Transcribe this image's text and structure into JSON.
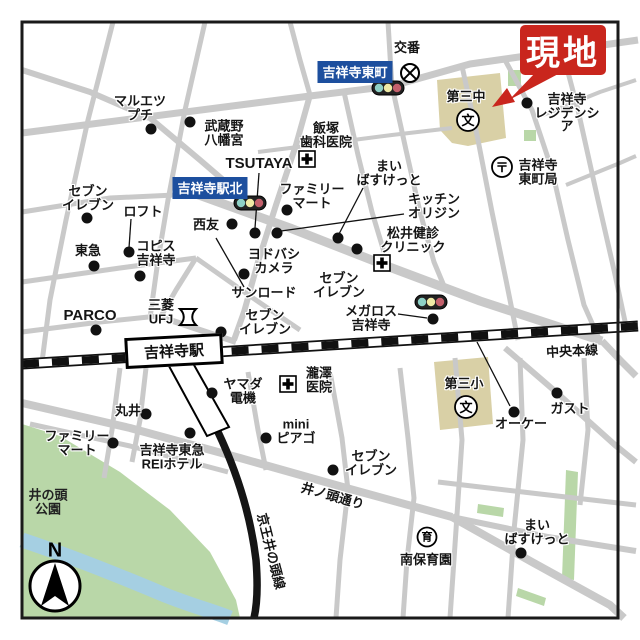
{
  "map": {
    "background": "#ffffff",
    "border_color": "#1a1a1a",
    "road_color": "#c9c9c9",
    "park_color": "#b9d7a8",
    "water_color": "#a5cfe2",
    "school_building_color": "#d9d0a6",
    "site_callout": {
      "label": "現地",
      "color": "#c9261d",
      "text_color": "#ffffff"
    },
    "sign_color": "#1d4f9e",
    "signs": [
      {
        "label": "吉祥寺東町",
        "x": 355,
        "y": 72
      },
      {
        "label": "吉祥寺駅北",
        "x": 210,
        "y": 188
      }
    ],
    "station_label": {
      "label": "吉祥寺駅"
    },
    "line_labels": [
      {
        "label": "中央本線",
        "x": 572,
        "y": 350,
        "rot": -3
      },
      {
        "label": "京王井の頭線",
        "x": 272,
        "y": 551,
        "rot": 76
      },
      {
        "label": "井ノ頭通り",
        "x": 333,
        "y": 495,
        "rot": 16
      }
    ],
    "area_labels": [
      {
        "label": "井の頭\n公園",
        "x": 48,
        "y": 503
      }
    ],
    "compass": {
      "label": "N"
    },
    "traffic_light_colors": [
      "#8ed1c6",
      "#efeaa6",
      "#c4606c"
    ],
    "traffic_lights": [
      [
        388,
        88
      ],
      [
        250,
        203
      ],
      [
        431,
        302
      ]
    ],
    "symbol_defs": {
      "school": {
        "glyph": "文"
      },
      "nursery": {
        "glyph": "育"
      },
      "post": {
        "glyph": "〒"
      },
      "koban": {
        "glyph": ""
      },
      "hospital": {
        "glyph": ""
      },
      "bank": {
        "glyph": ""
      }
    },
    "pois": [
      {
        "label": "マルエツ\nプチ",
        "lx": 140,
        "ly": 108,
        "dot": [
          151,
          129
        ]
      },
      {
        "label": "武蔵野\n八幡宮",
        "lx": 224,
        "ly": 133,
        "dot": [
          190,
          122
        ]
      },
      {
        "label": "飯塚\n歯科医院",
        "lx": 326,
        "ly": 135,
        "symbol": {
          "type": "hospital",
          "x": 307,
          "y": 159
        }
      },
      {
        "label": "TSUTAYA",
        "lx": 259,
        "ly": 164,
        "fs": 15,
        "dot": [
          255,
          233
        ],
        "leader": [
          259,
          173,
          255,
          228
        ]
      },
      {
        "label": "ファミリー\nマート",
        "lx": 312,
        "ly": 196,
        "dot": [
          287,
          210
        ]
      },
      {
        "label": "まい\nばすけっと",
        "lx": 389,
        "ly": 173,
        "dot": [
          338,
          238
        ],
        "leader": [
          363,
          188,
          339,
          234
        ]
      },
      {
        "label": "キッチン\nオリジン",
        "lx": 434,
        "ly": 206,
        "dot": [
          277,
          233
        ],
        "leader": [
          404,
          214,
          281,
          231
        ]
      },
      {
        "label": "松井健診\nクリニック",
        "lx": 413,
        "ly": 240,
        "symbol": {
          "type": "hospital",
          "x": 382,
          "y": 263
        }
      },
      {
        "label": "セブン\nイレブン",
        "lx": 88,
        "ly": 198,
        "dot": [
          87,
          218
        ]
      },
      {
        "label": "ロフト",
        "lx": 143,
        "ly": 212,
        "dot": [
          129,
          252
        ],
        "leader": [
          131,
          219,
          129,
          248
        ]
      },
      {
        "label": "西友",
        "lx": 206,
        "ly": 225,
        "dot": [
          232,
          224
        ]
      },
      {
        "label": "東急",
        "lx": 88,
        "ly": 251,
        "dot": [
          94,
          266
        ]
      },
      {
        "label": "コピス\n吉祥寺",
        "lx": 156,
        "ly": 253,
        "dot": [
          140,
          276
        ]
      },
      {
        "label": "ヨドバシ\nカメラ",
        "lx": 274,
        "ly": 261,
        "dot": [
          244,
          274
        ]
      },
      {
        "label": "サンロード",
        "lx": 264,
        "ly": 293,
        "leader": [
          244,
          287,
          216,
          238
        ]
      },
      {
        "label": "セブン\nイレブン",
        "lx": 339,
        "ly": 285,
        "dot": [
          357,
          249
        ]
      },
      {
        "label": "メガロス\n吉祥寺",
        "lx": 371,
        "ly": 318,
        "dot": [
          433,
          319
        ],
        "leader": [
          398,
          314,
          427,
          318
        ]
      },
      {
        "label": "三菱\nUFJ",
        "lx": 161,
        "ly": 312,
        "symbol": {
          "type": "bank",
          "x": 188,
          "y": 317
        }
      },
      {
        "label": "PARCO",
        "lx": 90,
        "ly": 316,
        "fs": 15,
        "dot": [
          96,
          330
        ]
      },
      {
        "label": "セブン\nイレブン",
        "lx": 265,
        "ly": 322,
        "dot": [
          221,
          332
        ]
      },
      {
        "label": "吉祥寺\nレジデンシア",
        "lx": 567,
        "ly": 113,
        "dot": [
          527,
          103
        ]
      },
      {
        "label": "第三中",
        "lx": 466,
        "ly": 97,
        "symbol": {
          "type": "school",
          "x": 468,
          "y": 120
        }
      },
      {
        "label": "吉祥寺\n東町局",
        "lx": 538,
        "ly": 172,
        "symbol": {
          "type": "post",
          "x": 502,
          "y": 167
        }
      },
      {
        "label": "交番",
        "lx": 407,
        "ly": 48,
        "symbol": {
          "type": "koban",
          "x": 410,
          "y": 73
        }
      },
      {
        "label": "ヤマダ\n電機",
        "lx": 243,
        "ly": 391,
        "dot": [
          212,
          393
        ]
      },
      {
        "label": "瀧澤\n医院",
        "lx": 319,
        "ly": 380,
        "symbol": {
          "type": "hospital",
          "x": 288,
          "y": 384
        }
      },
      {
        "label": "丸井",
        "lx": 128,
        "ly": 411,
        "dot": [
          146,
          414
        ]
      },
      {
        "label": "mini\nピアゴ",
        "lx": 296,
        "ly": 431,
        "dot": [
          266,
          438
        ]
      },
      {
        "label": "ファミリー\nマート",
        "lx": 77,
        "ly": 443,
        "dot": [
          113,
          443
        ]
      },
      {
        "label": "吉祥寺東急\nREIホテル",
        "lx": 172,
        "ly": 457,
        "dot": [
          190,
          433
        ]
      },
      {
        "label": "セブン\nイレブン",
        "lx": 371,
        "ly": 463,
        "dot": [
          333,
          470
        ]
      },
      {
        "label": "オーケー",
        "lx": 521,
        "ly": 424,
        "dot": [
          514,
          412
        ],
        "leader": [
          510,
          406,
          477,
          342
        ]
      },
      {
        "label": "ガスト",
        "lx": 570,
        "ly": 409,
        "dot": [
          557,
          393
        ]
      },
      {
        "label": "第三小",
        "lx": 464,
        "ly": 384,
        "symbol": {
          "type": "school",
          "x": 466,
          "y": 407
        }
      },
      {
        "label": "南保育園",
        "lx": 426,
        "ly": 560,
        "symbol": {
          "type": "nursery",
          "x": 427,
          "y": 537
        }
      },
      {
        "label": "まい\nばすけっと",
        "lx": 537,
        "ly": 532,
        "dot": [
          521,
          553
        ]
      }
    ]
  }
}
